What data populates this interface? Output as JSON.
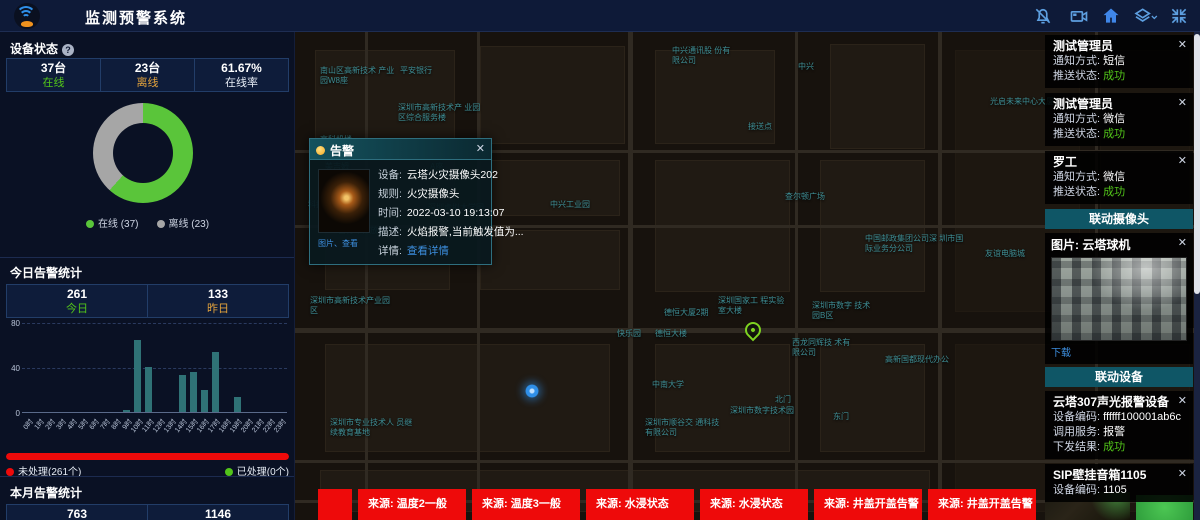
{
  "icons": {
    "close": "✕",
    "info": "?",
    "chevron": "▾"
  },
  "header": {
    "title": "监测预警系统",
    "icon_names": [
      "bell",
      "video-camera",
      "home",
      "layers",
      "fullscreen"
    ]
  },
  "device_status": {
    "title": "设备状态",
    "stats": [
      {
        "value": "37台",
        "label": "在线"
      },
      {
        "value": "23台",
        "label": "离线"
      },
      {
        "value": "61.67%",
        "label": "在线率"
      }
    ],
    "chart": {
      "type": "pie",
      "labels": [
        "在线",
        "离线"
      ],
      "values": [
        37,
        23
      ],
      "colors": [
        "#5ac53a",
        "#a6a6a6"
      ],
      "legend": [
        "在线 (37)",
        "离线 (23)"
      ]
    }
  },
  "today_alerts": {
    "title": "今日告警统计",
    "stats": [
      {
        "value": "261",
        "label": "今日"
      },
      {
        "value": "133",
        "label": "昨日"
      }
    ],
    "chart": {
      "type": "bar",
      "categories": [
        "0时",
        "1时",
        "2时",
        "3时",
        "4时",
        "5时",
        "6时",
        "7时",
        "8时",
        "9时",
        "10时",
        "11时",
        "12时",
        "13时",
        "14时",
        "15时",
        "16时",
        "17时",
        "18时",
        "19时",
        "20时",
        "21时",
        "22时",
        "23时"
      ],
      "values": [
        0,
        0,
        0,
        0,
        0,
        0,
        0,
        0,
        0,
        2,
        64,
        40,
        0,
        0,
        33,
        36,
        20,
        53,
        0,
        13,
        0,
        0,
        0,
        0
      ],
      "ylim": [
        0,
        80
      ],
      "yticks": [
        0,
        40,
        80
      ],
      "bar_color": "#2f7276"
    },
    "progress": {
      "unhandled_label": "未处理(261个)",
      "handled_label": "已处理(0个)",
      "unhandled": 261,
      "handled": 0,
      "percent_unhandled": 100
    }
  },
  "month_alerts": {
    "title": "本月告警统计",
    "stats": [
      {
        "value": "763"
      },
      {
        "value": "1146"
      }
    ]
  },
  "map": {
    "labels": [
      {
        "t": "南山区高新技术 产业园W8座",
        "x": 25,
        "y": 34,
        "w": 80
      },
      {
        "t": "平安银行",
        "x": 105,
        "y": 34
      },
      {
        "t": "深圳市高新技术产 业园区综合服务楼",
        "x": 103,
        "y": 71,
        "w": 90
      },
      {
        "t": "高科机楼",
        "x": 25,
        "y": 103
      },
      {
        "t": "美吉姆",
        "x": 30,
        "y": 130
      },
      {
        "t": "A座",
        "x": 135,
        "y": 130
      },
      {
        "t": "科技园南区附区",
        "x": 13,
        "y": 168
      },
      {
        "t": "深圳虚拟大学园",
        "x": 133,
        "y": 171
      },
      {
        "t": "中兴工业园",
        "x": 255,
        "y": 168
      },
      {
        "t": "自行车停放处",
        "x": 43,
        "y": 194
      },
      {
        "t": "深圳市高新技术产业园区",
        "x": 15,
        "y": 264,
        "w": 85
      },
      {
        "t": "深圳市专业技术人 员继续教育基地",
        "x": 35,
        "y": 386,
        "w": 90
      },
      {
        "t": "中兴通讯股 份有限公司",
        "x": 377,
        "y": 14,
        "w": 62
      },
      {
        "t": "中兴",
        "x": 503,
        "y": 30
      },
      {
        "t": "光启未来中心大厦",
        "x": 695,
        "y": 65
      },
      {
        "t": "接送点",
        "x": 453,
        "y": 90
      },
      {
        "t": "查尔顿广场",
        "x": 490,
        "y": 160
      },
      {
        "t": "中国邮政集团公司深 圳市国际业务分公司",
        "x": 570,
        "y": 202,
        "w": 100
      },
      {
        "t": "友谊电脑城",
        "x": 690,
        "y": 217
      },
      {
        "t": "德恒大厦2期",
        "x": 369,
        "y": 276
      },
      {
        "t": "快乐园",
        "x": 322,
        "y": 297
      },
      {
        "t": "德恒大楼",
        "x": 360,
        "y": 297
      },
      {
        "t": "深圳国家工 程实验室大楼",
        "x": 423,
        "y": 264,
        "w": 70
      },
      {
        "t": "深圳市数字 技术园B区",
        "x": 517,
        "y": 269,
        "w": 62
      },
      {
        "t": "西龙同辉技 术有限公司",
        "x": 497,
        "y": 306,
        "w": 62
      },
      {
        "t": "高新国都现代办公",
        "x": 590,
        "y": 323
      },
      {
        "t": "中南大学",
        "x": 357,
        "y": 348
      },
      {
        "t": "北门",
        "x": 480,
        "y": 363
      },
      {
        "t": "东门",
        "x": 538,
        "y": 380
      },
      {
        "t": "深圳市数字技术园",
        "x": 435,
        "y": 374
      },
      {
        "t": "深圳市顺谷交 通科技有限公司",
        "x": 350,
        "y": 386,
        "w": 80
      }
    ],
    "pin": {
      "x": 450,
      "y": 290
    },
    "dot": {
      "x": 230,
      "y": 352
    },
    "popup": {
      "title": "告警",
      "rows": [
        {
          "label": "设备:",
          "value": "云塔火灾摄像头202"
        },
        {
          "label": "规则:",
          "value": "火灾摄像头"
        },
        {
          "label": "时间:",
          "value": "2022-03-10 19:13:07"
        },
        {
          "label": "描述:",
          "value": "火焰报警,当前触发值为..."
        }
      ],
      "detail_label": "详情:",
      "detail_link": "查看详情",
      "thumb_caption": "图片、查看"
    }
  },
  "notifications": [
    {
      "name": "测试管理员",
      "rows": [
        [
          "通知方式:",
          "短信"
        ],
        [
          "推送状态:",
          "成功"
        ]
      ]
    },
    {
      "name": "测试管理员",
      "rows": [
        [
          "通知方式:",
          "微信"
        ],
        [
          "推送状态:",
          "成功"
        ]
      ]
    },
    {
      "name": "罗工",
      "rows": [
        [
          "通知方式:",
          "微信"
        ],
        [
          "推送状态:",
          "成功"
        ]
      ]
    }
  ],
  "camera_section": {
    "title": "联动摄像头",
    "card_title": "图片: 云塔球机",
    "download_label": "下载"
  },
  "device_section": {
    "title": "联动设备",
    "cards": [
      {
        "name": "云塔307声光报警设备",
        "rows": [
          [
            "设备编码:",
            "ffffff100001ab6c"
          ],
          [
            "调用服务:",
            "报警"
          ],
          [
            "下发结果:",
            "成功"
          ]
        ]
      },
      {
        "name": "SIP壁挂音箱1105",
        "rows": [
          [
            "设备编码:",
            "1105"
          ]
        ]
      }
    ]
  },
  "bottom_alerts": [
    {
      "label": ""
    },
    {
      "label": "来源: 温度2一般"
    },
    {
      "label": "来源: 温度3一般"
    },
    {
      "label": "来源: 水浸状态"
    },
    {
      "label": "来源: 水浸状态"
    },
    {
      "label": "来源: 井盖开盖告警"
    },
    {
      "label": "来源: 井盖开盖告警"
    }
  ]
}
